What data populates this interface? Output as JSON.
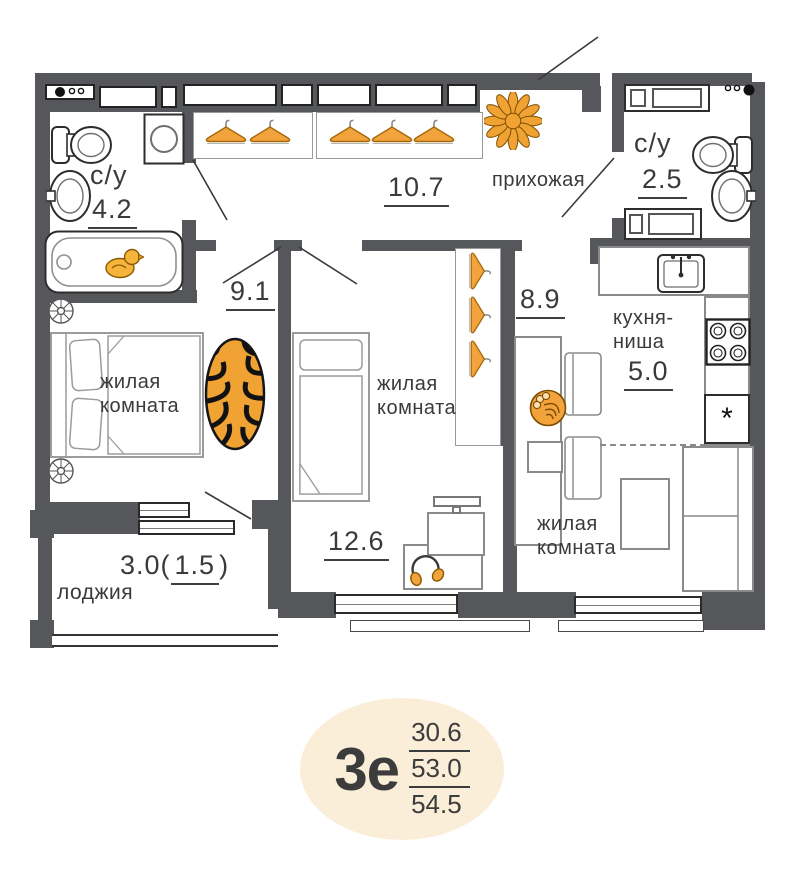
{
  "plan_labels": {
    "bathroom_left": {
      "name": "с/у",
      "area": "4.2"
    },
    "hallway": {
      "area": "10.7"
    },
    "entry_hall": {
      "name": "прихожая"
    },
    "bathroom_right": {
      "name": "с/у",
      "area": "2.5"
    },
    "corridor": {
      "area": "9.1"
    },
    "kitchen_hall": {
      "area": "8.9"
    },
    "bedroom_left": {
      "name_line1": "жилая",
      "name_line2": "комната"
    },
    "room_middle": {
      "name_line1": "жилая",
      "name_line2": "комната",
      "area": "12.6"
    },
    "room_right": {
      "name_line1": "жилая",
      "name_line2": "комната"
    },
    "kitchen": {
      "name_line1": "кухня-",
      "name_line2": "ниша",
      "area": "5.0"
    },
    "loggia": {
      "name": "лоджия",
      "area_prefix": "3.0(",
      "area_reduced": "1.5",
      "area_suffix": ")"
    }
  },
  "badge": {
    "plan_type": "3е",
    "values": [
      "30.6",
      "53.0",
      "54.5"
    ]
  },
  "symbols": {
    "kitchen_star": "*"
  },
  "colors": {
    "wall": "#56575a",
    "accent_orange": "#f2a33c",
    "badge_bg": "#fbeed8",
    "ink": "#3a3a3a"
  }
}
